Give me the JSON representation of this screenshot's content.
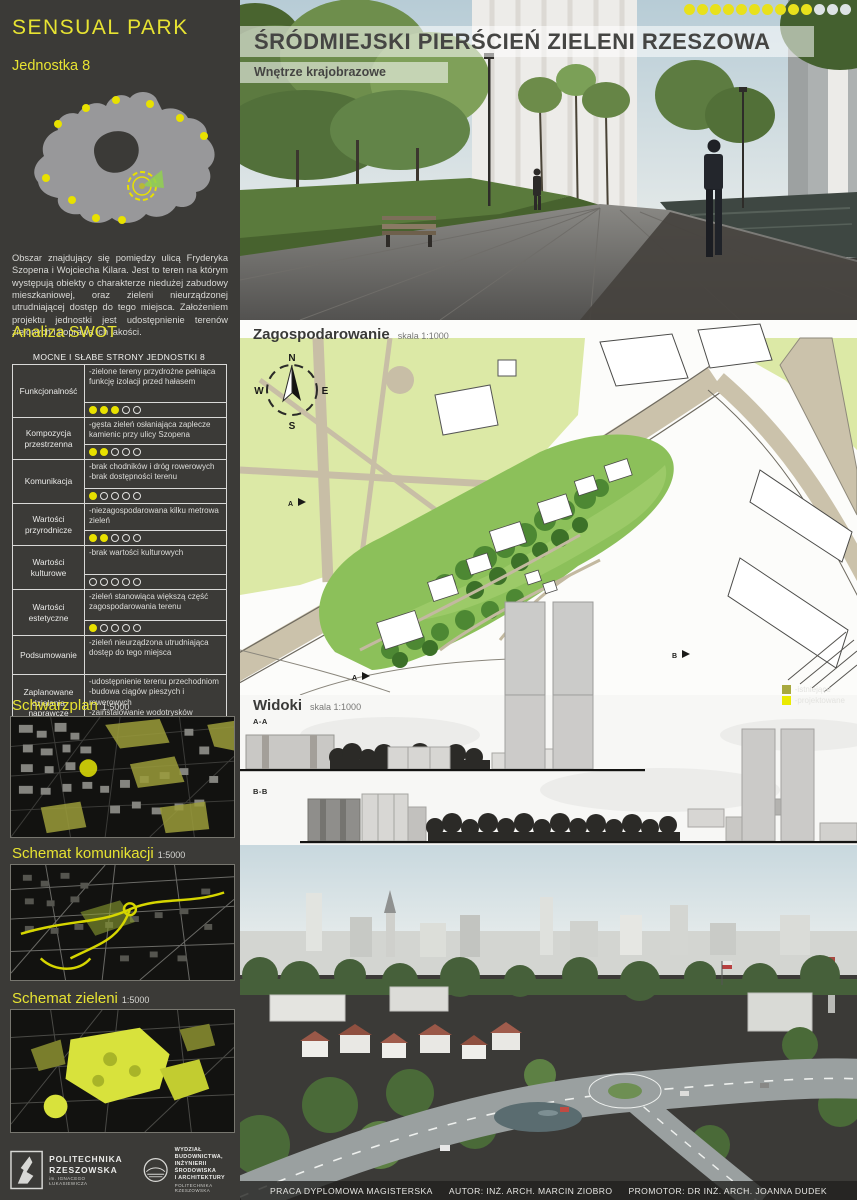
{
  "pagination": {
    "total": 13,
    "filled": 10
  },
  "sidebar": {
    "title": "SENSUAL PARK",
    "subtitle": "Jednostka 8",
    "description": "Obszar znajdujący się pomiędzy ulicą Fryderyka Szopena i Wojciecha Kilara. Jest to teren na którym występują obiekty o charakterze niedużej zabudowy mieszkaniowej, oraz zieleni nieurządzonej utrudniającej dostęp do tego miejsca. Założeniem projektu jednostki jest udostępnienie terenów zielonych i poprawa ich jakości.",
    "swot_heading": "Analiza SWOT",
    "swot": {
      "table_title": "MOCNE I SŁABE STRONY JEDNOSTKI 8",
      "rating_max": 5,
      "rows": [
        {
          "label": "Funkcjonalność",
          "text": "-zielone tereny przydrożne pełniąca funkcję izolacji przed hałasem",
          "rating": 3
        },
        {
          "label": "Kompozycja przestrzenna",
          "text": "-gęsta zieleń osłaniająca zaplecze kamienic przy ulicy Szopena",
          "rating": 2
        },
        {
          "label": "Komunikacja",
          "text": "-brak chodników i dróg rowerowych\n-brak dostępności terenu",
          "rating": 1
        },
        {
          "label": "Wartości przyrodnicze",
          "text": "-niezagospodarowana kilku metrowa zieleń",
          "rating": 2
        },
        {
          "label": "Wartości kulturowe",
          "text": "-brak wartości kulturowych",
          "rating": 0
        },
        {
          "label": "Wartości estetyczne",
          "text": "-zieleń stanowiąca większą część zagospodarowania terenu",
          "rating": 1
        },
        {
          "label": "Podsumowanie",
          "text": "-zieleń nieurządzona utrudniająca dostęp do tego miejsca",
          "rating": null
        },
        {
          "label": "Zaplanowane działania naprawcze",
          "text": "-udostępnienie terenu przechodniom\n-budowa ciągów pieszych i rowerowych\n-zainstalowanie wodotrysków wygłuszających hałas z ulicy",
          "rating": null
        }
      ]
    },
    "legend": [
      {
        "label": "-istniejące",
        "color": "#a8a93f"
      },
      {
        "label": "-projektowane",
        "color": "#eaea00"
      }
    ],
    "maps": [
      {
        "title": "Schwarzplan",
        "scale": "1:5000"
      },
      {
        "title": "Schemat komunikacji",
        "scale": "1:5000"
      },
      {
        "title": "Schemat zieleni",
        "scale": "1:5000"
      }
    ],
    "logos": {
      "university": "POLITECHNIKA\nRZESZOWSKA",
      "university_sub": "im. IGNACEGO ŁUKASIEWICZA",
      "faculty": "WYDZIAŁ\nBUDOWNICTWA,\nINŻYNIERII ŚRODOWISKA\nI ARCHITEKTURY",
      "faculty_sub": "POLITECHNIKA RZESZOWSKA"
    }
  },
  "main": {
    "title": "ŚRÓDMIEJSKI PIERŚCIEŃ ZIELENI RZESZOWA",
    "subtitle": "Wnętrze krajobrazowe",
    "plan": {
      "title": "Zagospodarowanie",
      "scale": "skala 1:1000",
      "compass": {
        "n": "N",
        "e": "E",
        "s": "S",
        "w": "W"
      }
    },
    "views": {
      "title": "Widoki",
      "scale": "skala 1:1000",
      "section_a": "A-A",
      "section_b": "B-B"
    },
    "footer": {
      "project": "PRACA DYPLOMOWA MAGISTERSKA",
      "author": "AUTOR: INŻ. ARCH. MARCIN ZIOBRO",
      "promoter": "PROMOTOR: DR INŻ. ARCH. JOANNA DUDEK"
    }
  }
}
